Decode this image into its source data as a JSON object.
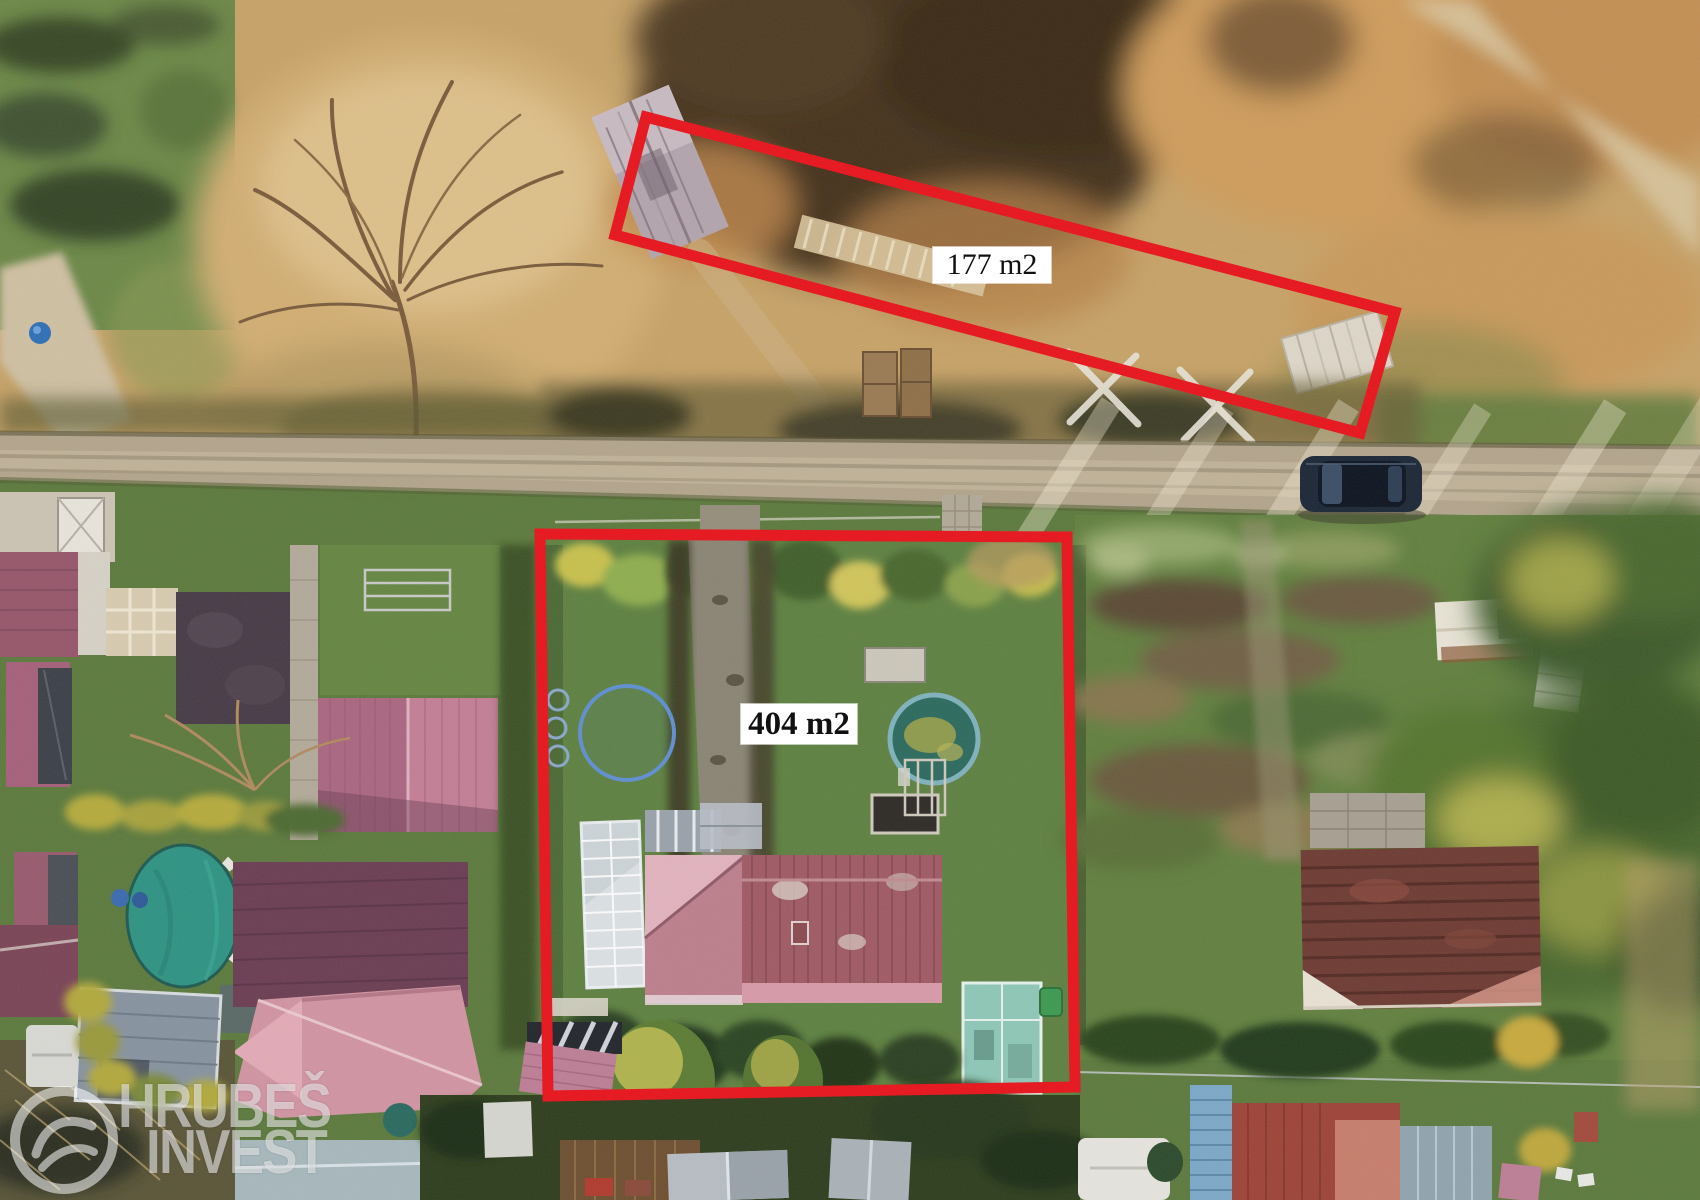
{
  "annotations": {
    "plots": [
      {
        "id": "plot-177",
        "area_label": "177 m2"
      },
      {
        "id": "plot-404",
        "area_label": "404 m2"
      }
    ],
    "outline_color": "#e8131b",
    "label_bg": "#ffffff",
    "label_text_color": "#111111"
  },
  "watermark": {
    "line1": "HRUBEŠ",
    "line2": "INVEST",
    "logo": "hrubes-invest-logo",
    "color": "rgba(255,255,255,0.55)"
  },
  "scene_palette": {
    "autumn_grass": "#c7a368",
    "dirt_road": "#b3a58c",
    "lawn_green": "#5e8141",
    "pool_teal": "#2e9383",
    "pool_ring_blue": "#5f8fd0",
    "roof_pink": "#c37e96",
    "roof_maroon": "#6e3b33",
    "main_house_roof": "#a05a64",
    "car_navy": "#1b2736",
    "greenhouse_glass": "#ccd4d8",
    "teal_pavilion": "#8ec7b7"
  }
}
